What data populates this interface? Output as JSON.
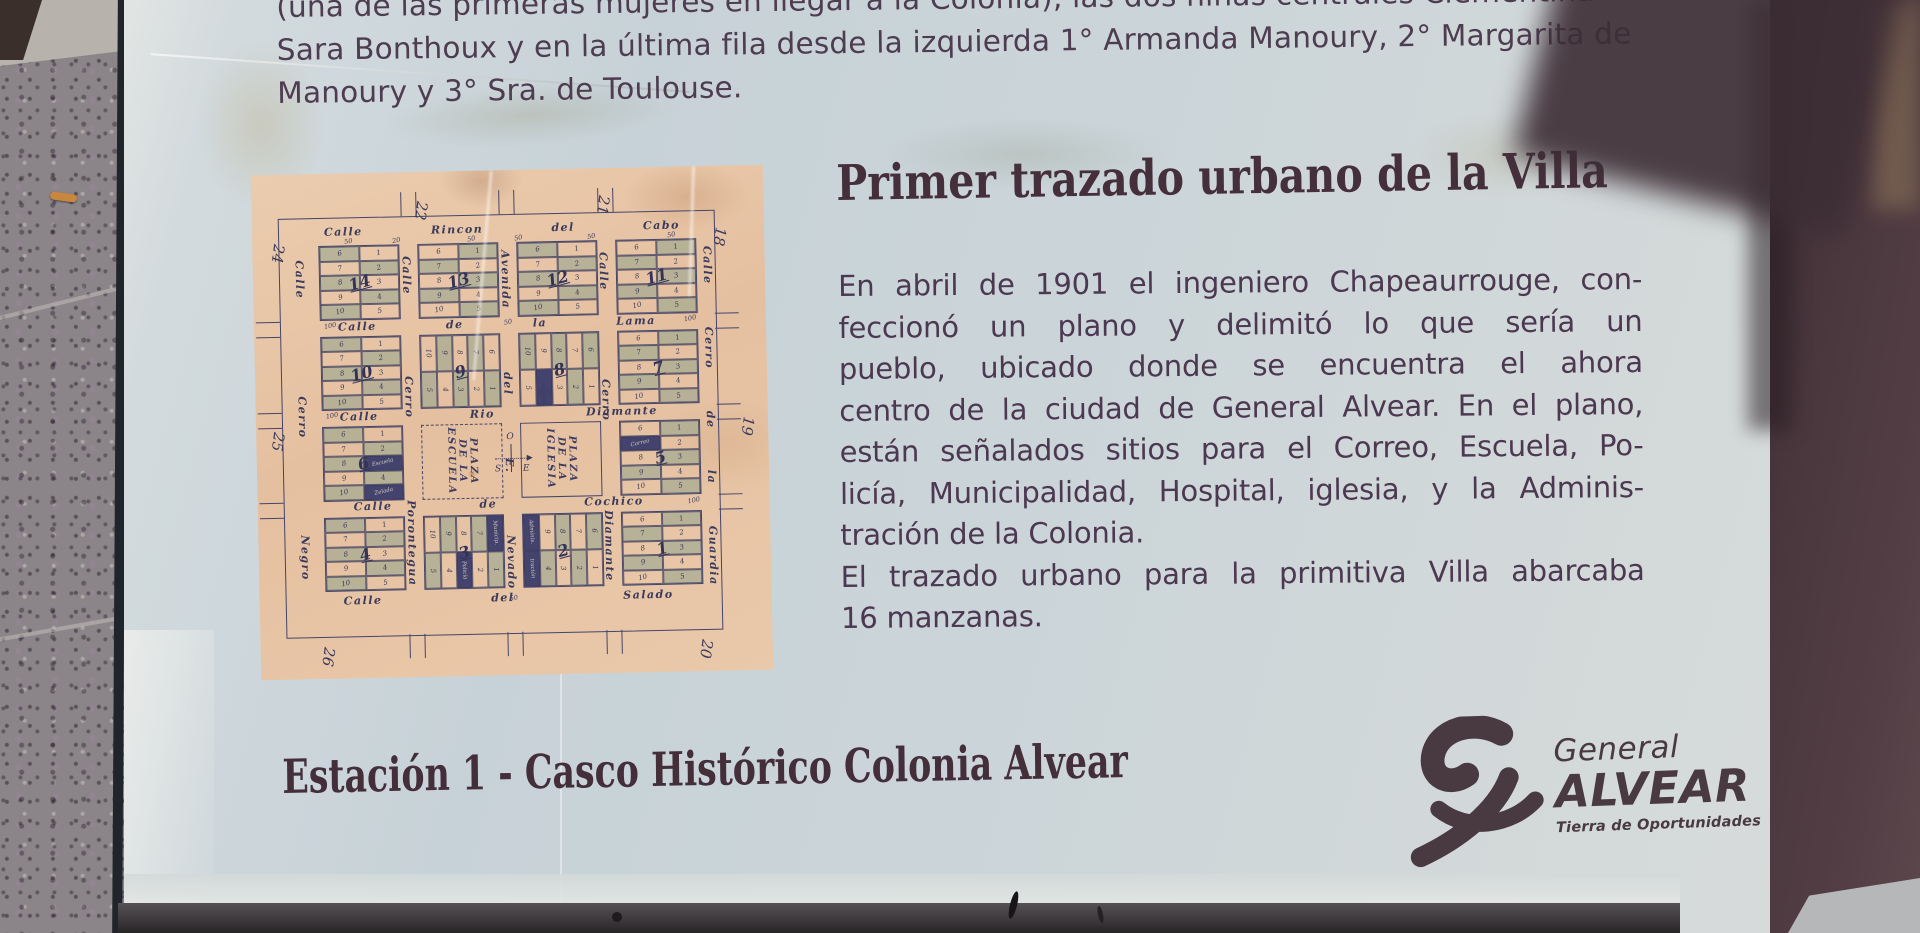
{
  "plaque": {
    "top_paragraph": {
      "lines": [
        "(una de las primeras mujeres en llegar a la Colonia), las dos niñas centrales Clementina",
        "Sara Bonthoux y en la última fila desde la izquierda 1° Armanda Manoury, 2° Margarita de",
        "Manoury y 3° Sra. de Toulouse."
      ]
    },
    "heading": "Primer trazado urbano de la Villa",
    "body_lines": [
      {
        "t": "En abril de 1901 el ingeniero Chapeaurrouge, con-",
        "j": true
      },
      {
        "t": "feccionó un plano y delimitó lo que sería un",
        "j": true
      },
      {
        "t": "pueblo, ubicado donde se encuentra el ahora",
        "j": true
      },
      {
        "t": "centro de la ciudad de General Alvear. En el plano,",
        "j": true
      },
      {
        "t": "están señalados sitios para el Correo, Escuela, Po-",
        "j": true
      },
      {
        "t": "licía, Municipalidad, Hospital, iglesia, y la Adminis-",
        "j": true
      },
      {
        "t": "tración de la Colonia.",
        "j": false
      },
      {
        "t": "El trazado urbano para la primitiva Villa abarcaba",
        "j": true
      },
      {
        "t": "16 manzanas.",
        "j": false
      }
    ],
    "station_title": "Estación 1 - Casco Histórico Colonia Alvear",
    "logo": {
      "region": "General",
      "name": "ALVEAR",
      "tagline": "Tierra de Oportunidades"
    }
  },
  "map": {
    "paper_color": "#e7c6a6",
    "ink_color": "#45456a",
    "section_numbers": [
      "24",
      "22",
      "21",
      "18",
      "19",
      "20",
      "26",
      "25"
    ],
    "horizontal_streets": [
      "Calle Rincon del Cabo",
      "Calle de la Lama",
      "Calle Rio Diamante",
      "Calle de Cochico",
      "Calle del Salado"
    ],
    "vertical_streets": [
      "Calle Cerro Negro",
      "Calle Cerro Porontegua",
      "Avenida del E. Nevado",
      "Calle Cerro Diamante",
      "Calle Cerro de la Guardia"
    ],
    "blocks": [
      {
        "n": "14",
        "t": "h"
      },
      {
        "n": "13",
        "t": "h"
      },
      {
        "n": "12",
        "t": "h"
      },
      {
        "n": "11",
        "t": "h"
      },
      {
        "n": "10",
        "t": "h"
      },
      {
        "n": "9",
        "t": "v"
      },
      {
        "n": "8",
        "t": "v",
        "cross": true,
        "marks": [
          {
            "r": 1,
            "c": 1,
            "label": ""
          }
        ]
      },
      {
        "n": "7",
        "t": "h"
      },
      {
        "n": "6",
        "t": "h",
        "marks": [
          {
            "r": 2,
            "c": 1,
            "label": "Escuela"
          },
          {
            "r": 4,
            "c": 1,
            "label": "Zelada"
          }
        ]
      },
      {
        "t": "plaza",
        "style": "dashed",
        "label": "PLAZA\nDE LA\nESCUELA"
      },
      {
        "t": "plaza",
        "style": "solid",
        "label": "PLAZA\nDE LA\nIGLESIA"
      },
      {
        "n": "5",
        "t": "h",
        "marks": [
          {
            "r": 1,
            "c": 0,
            "label": "Correo"
          }
        ]
      },
      {
        "n": "4",
        "t": "h"
      },
      {
        "n": "3",
        "t": "v",
        "marks": [
          {
            "r": 0,
            "c": 4,
            "label": "Municip."
          },
          {
            "r": 1,
            "c": 2,
            "label": "Policía"
          }
        ]
      },
      {
        "n": "2",
        "t": "v",
        "marks": [
          {
            "r": 0,
            "c": 0,
            "label": "Adminis."
          },
          {
            "r": 1,
            "c": 0,
            "label": "tración"
          }
        ]
      },
      {
        "n": "1",
        "t": "h"
      }
    ],
    "lot_numbers": {
      "h_left": [
        "6",
        "7",
        "8",
        "9",
        "10"
      ],
      "h_right": [
        "1",
        "2",
        "3",
        "4",
        "5"
      ],
      "v_top": [
        "10",
        "9",
        "8",
        "7",
        "6"
      ],
      "v_bottom": [
        "5",
        "4",
        "3",
        "2",
        "1"
      ]
    },
    "dimension_labels": [
      "50",
      "20",
      "50",
      "50",
      "50",
      "50",
      "100",
      "50",
      "100",
      "100",
      "100",
      "50"
    ],
    "compass": {
      "w": "O",
      "e": "E",
      "s": "S"
    }
  },
  "colors": {
    "plaque_bg": "#cbd5d9",
    "body_text": "#4c3850",
    "heading_text": "#452f3b",
    "maroon_panel": "#4a373e",
    "pavement": "#8b8589",
    "map_paper": "#e7c6a6",
    "map_ink": "#45456a",
    "lot_shade": "#8fa38d"
  }
}
